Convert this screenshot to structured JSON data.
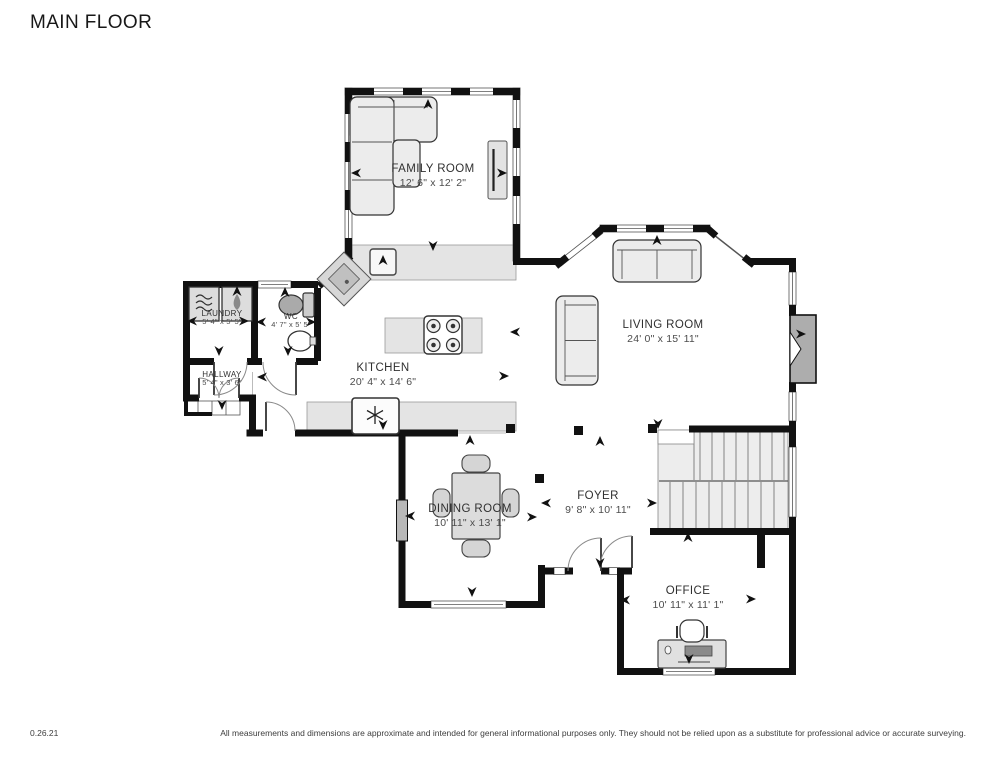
{
  "title": "MAIN FLOOR",
  "rooms": {
    "family_room": {
      "name": "FAMILY ROOM",
      "dims": "12' 6\" x 12' 2\""
    },
    "living_room": {
      "name": "LIVING ROOM",
      "dims": "24' 0\" x 15' 11\""
    },
    "kitchen": {
      "name": "KITCHEN",
      "dims": "20' 4\" x 14' 6\""
    },
    "dining_room": {
      "name": "DINING ROOM",
      "dims": "10' 11\" x 13' 1\""
    },
    "foyer": {
      "name": "FOYER",
      "dims": "9' 8\" x 10' 11\""
    },
    "office": {
      "name": "OFFICE",
      "dims": "10' 11\" x 11' 1\""
    },
    "laundry": {
      "name": "LAUNDRY",
      "dims": "5' 4\" x 5' 5\""
    },
    "wc": {
      "name": "WC",
      "dims": "4' 7\" x 5' 5\""
    },
    "hallway": {
      "name": "HALLWAY",
      "dims": "5' 4\" x 3' 6\""
    }
  },
  "footer": {
    "version": "0.26.21",
    "disclaimer": "All measurements and dimensions are approximate and intended for general informational purposes only. They should not be relied upon as a substitute for professional advice or accurate surveying."
  },
  "plan": {
    "wall_color": "#111111",
    "counter_color": "#e4e4e4",
    "stairs_color": "#ededed",
    "arrows": [
      {
        "x": 428,
        "y": 105,
        "d": "up"
      },
      {
        "x": 357,
        "y": 173,
        "d": "left"
      },
      {
        "x": 501,
        "y": 173,
        "d": "right"
      },
      {
        "x": 433,
        "y": 245,
        "d": "down"
      },
      {
        "x": 383,
        "y": 261,
        "d": "up"
      },
      {
        "x": 657,
        "y": 241,
        "d": "up"
      },
      {
        "x": 516,
        "y": 332,
        "d": "left"
      },
      {
        "x": 503,
        "y": 376,
        "d": "right"
      },
      {
        "x": 800,
        "y": 334,
        "d": "right"
      },
      {
        "x": 658,
        "y": 423,
        "d": "down"
      },
      {
        "x": 263,
        "y": 377,
        "d": "left"
      },
      {
        "x": 470,
        "y": 441,
        "d": "up"
      },
      {
        "x": 600,
        "y": 442,
        "d": "up"
      },
      {
        "x": 547,
        "y": 503,
        "d": "left"
      },
      {
        "x": 651,
        "y": 503,
        "d": "right"
      },
      {
        "x": 688,
        "y": 538,
        "d": "up"
      },
      {
        "x": 600,
        "y": 562,
        "d": "down"
      },
      {
        "x": 472,
        "y": 591,
        "d": "down"
      },
      {
        "x": 411,
        "y": 516,
        "d": "left"
      },
      {
        "x": 531,
        "y": 517,
        "d": "right"
      },
      {
        "x": 626,
        "y": 600,
        "d": "left"
      },
      {
        "x": 750,
        "y": 599,
        "d": "right"
      },
      {
        "x": 689,
        "y": 658,
        "d": "down"
      },
      {
        "x": 193,
        "y": 321,
        "d": "left"
      },
      {
        "x": 243,
        "y": 321,
        "d": "right"
      },
      {
        "x": 237,
        "y": 292,
        "d": "up"
      },
      {
        "x": 262,
        "y": 322,
        "d": "left"
      },
      {
        "x": 310,
        "y": 322,
        "d": "right"
      },
      {
        "x": 285,
        "y": 293,
        "d": "up"
      },
      {
        "x": 219,
        "y": 350,
        "d": "down"
      },
      {
        "x": 288,
        "y": 350,
        "d": "down"
      },
      {
        "x": 222,
        "y": 404,
        "d": "down"
      },
      {
        "x": 383,
        "y": 424,
        "d": "down"
      }
    ]
  }
}
